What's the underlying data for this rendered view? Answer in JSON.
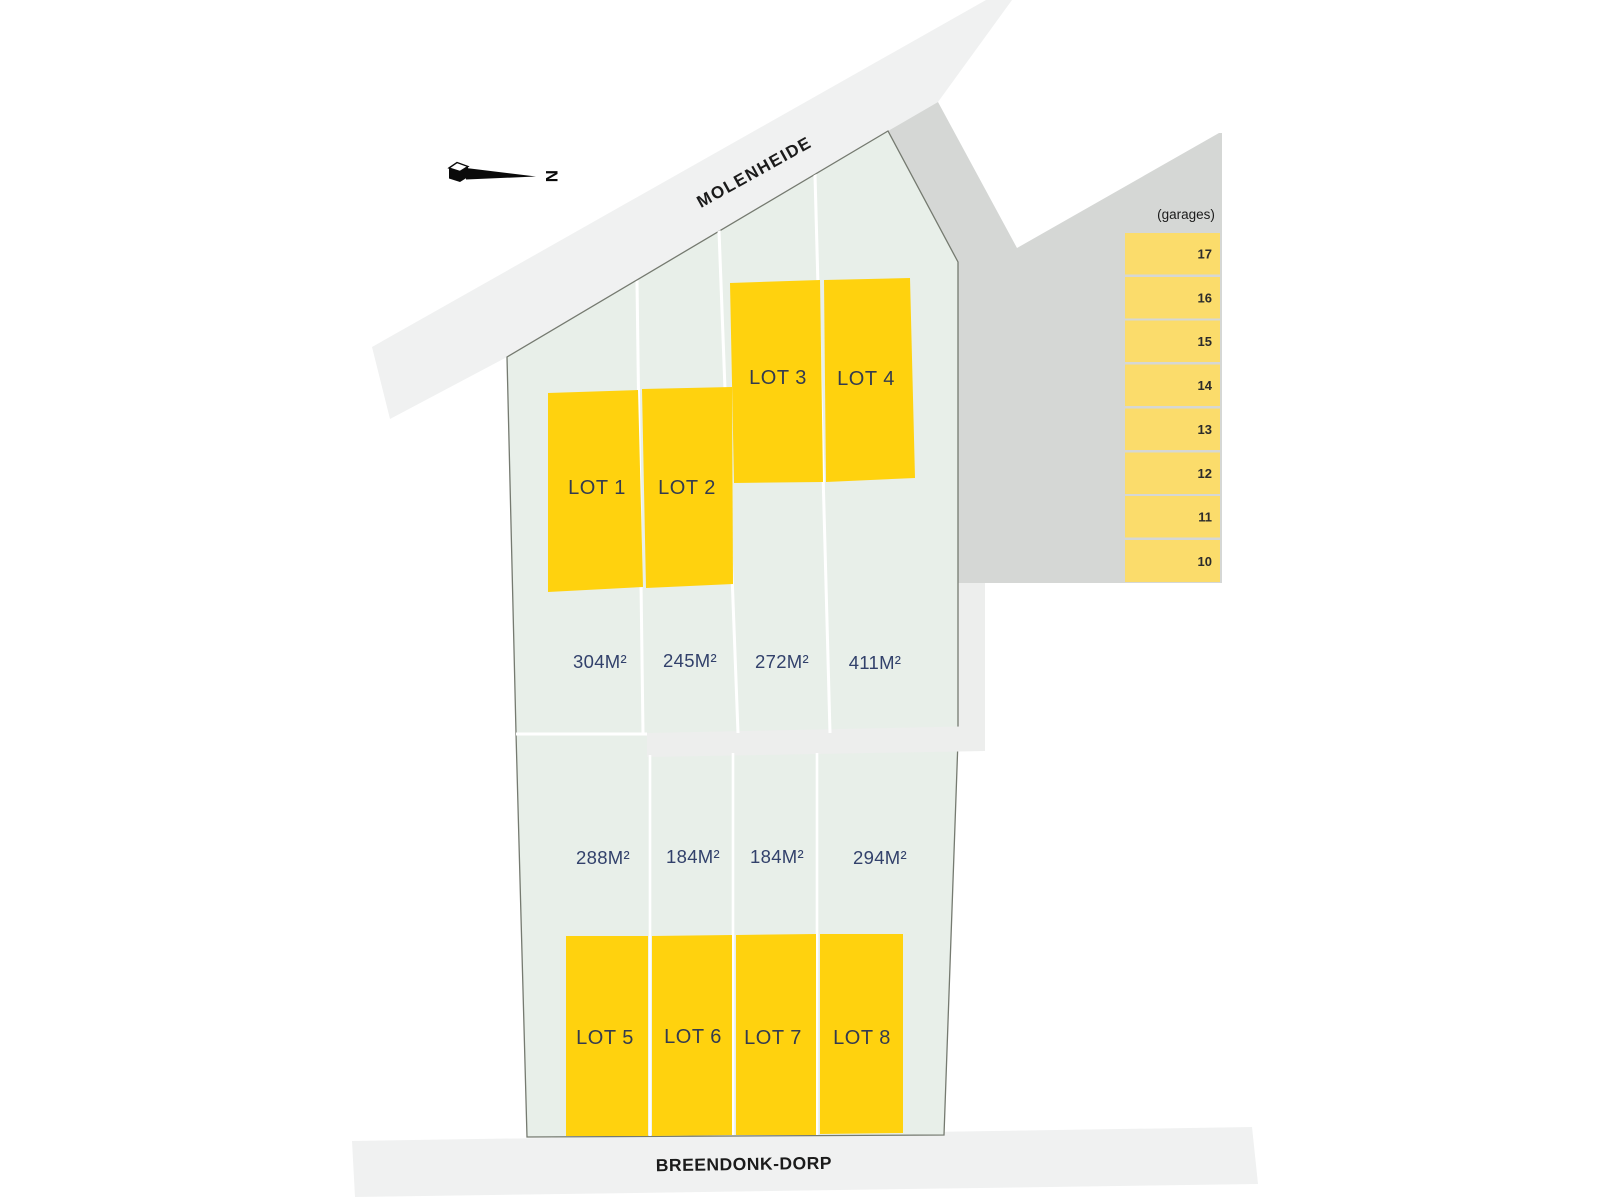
{
  "compass": {
    "north_label": "N"
  },
  "streets": {
    "top_street": "MOLENHEIDE",
    "bottom_street": "BREENDONK-DORP"
  },
  "garages": {
    "title": "(garages)",
    "units": [
      "17",
      "16",
      "15",
      "14",
      "13",
      "12",
      "11",
      "10"
    ]
  },
  "lots": {
    "row_top": [
      {
        "label": "LOT 1",
        "area": "304M²"
      },
      {
        "label": "LOT 2",
        "area": "245M²"
      },
      {
        "label": "LOT 3",
        "area": "272M²"
      },
      {
        "label": "LOT 4",
        "area": "411M²"
      }
    ],
    "row_bottom": [
      {
        "label": "LOT 5",
        "area": "288M²"
      },
      {
        "label": "LOT 6",
        "area": "184M²"
      },
      {
        "label": "LOT 7",
        "area": "184M²"
      },
      {
        "label": "LOT 8",
        "area": "294M²"
      }
    ]
  },
  "colors": {
    "lot_yellow": "#FFD20E",
    "garage_yellow": "#FBDC6B",
    "parcel_green": "#E8EFE9",
    "area_gray": "#D5D7D5",
    "road_gray": "#F0F1F1",
    "path_gray": "#EDEEED",
    "divider_white": "#FFFFFF",
    "outline": "#757A70",
    "lot_label": "#333B4F",
    "area_label": "#32416B",
    "street_label": "#1B1B1B",
    "garage_number": "#2B2B2B",
    "north_black": "#0A0A0A"
  }
}
